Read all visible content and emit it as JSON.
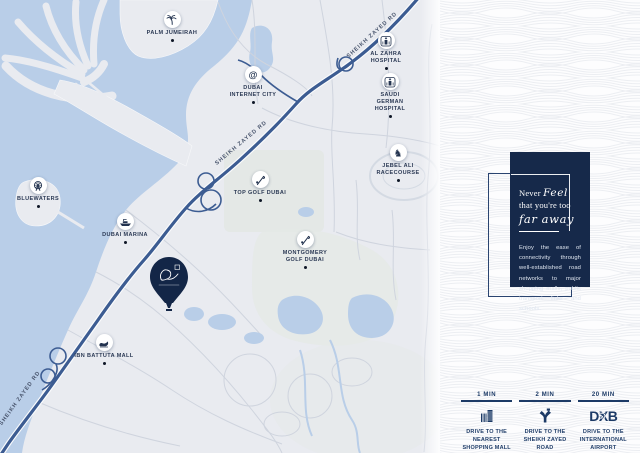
{
  "map": {
    "road_labels": [
      "SHEIKH ZAYED RD",
      "SHEIKH ZAYED RD",
      "SHEIKH ZAYED RD"
    ],
    "markers": [
      {
        "label": "PALM JUMEIRAH",
        "icon": "palm-icon"
      },
      {
        "label": "DUBAI INTERNET CITY",
        "icon": "at-icon"
      },
      {
        "label": "AL ZAHRA HOSPITAL",
        "icon": "hospital-icon"
      },
      {
        "label": "SAUDI GERMAN HOSPITAL",
        "icon": "hospital-icon"
      },
      {
        "label": "BLUEWATERS",
        "icon": "ferris-wheel-icon"
      },
      {
        "label": "DUBAI MARINA",
        "icon": "boat-icon"
      },
      {
        "label": "TOP GOLF DUBAI",
        "icon": "golf-icon"
      },
      {
        "label": "JEBEL ALI RACECOURSE",
        "icon": "horse-icon"
      },
      {
        "label": "MONTGOMERY GOLF DUBAI",
        "icon": "golf-icon"
      },
      {
        "label": "IBN BATTUTA MALL",
        "icon": "shoe-icon"
      }
    ],
    "development_pin": {
      "icon": "balloon-pin"
    }
  },
  "panel": {
    "heading_never": "Never",
    "heading_feel": "Feel",
    "heading_line2": "that you're too",
    "heading_line3": "far away",
    "body": "Enjoy the ease of connectivity through well-established road networks to major shopping malls, public transport links and schools."
  },
  "drive_times": [
    {
      "time": "1 MIN",
      "icon": "mall-icon",
      "caption": "DRIVE TO THE NEAREST SHOPPING MALL"
    },
    {
      "time": "2 MIN",
      "icon": "road-junction-icon",
      "caption": "DRIVE TO THE SHEIKH ZAYED ROAD"
    },
    {
      "time": "20 MIN",
      "icon": "dxb-logo",
      "logo_text": "DXB",
      "plane_glyph": "✈",
      "caption": "DRIVE TO THE INTERNATIONAL AIRPORT"
    }
  ],
  "colors": {
    "sea": "#b9cee8",
    "land": "#e9ebf0",
    "main_road": "#3c5c92",
    "panel_bg": "#16294a",
    "legend_text": "#1c3a66"
  }
}
